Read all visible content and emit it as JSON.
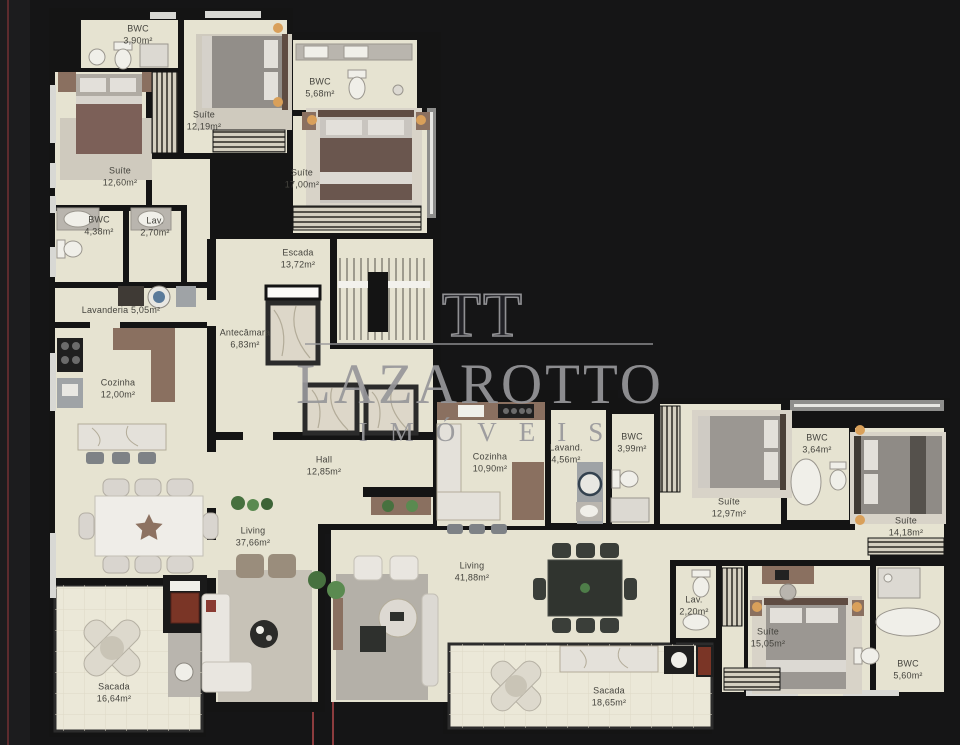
{
  "watermark": {
    "logo": "TT",
    "brand": "LAZAROTTO",
    "subtitle": "IMÓVEIS"
  },
  "colors": {
    "background": "#151516",
    "floor": "#e6e3d1",
    "balcony_floor": "#ebe8d8",
    "wall": "#141414",
    "watermark_gray": "#98989b",
    "guide_red": "#8c3c3e",
    "label_text": "#45443e"
  },
  "rooms": [
    {
      "id": "bwc-390",
      "lines": [
        "BWC",
        "3,90m²"
      ],
      "x": 138,
      "y": 35
    },
    {
      "id": "suite-1219",
      "lines": [
        "Suíte",
        "12,19m²"
      ],
      "x": 204,
      "y": 121
    },
    {
      "id": "bwc-568",
      "lines": [
        "BWC",
        "5,68m²"
      ],
      "x": 320,
      "y": 88
    },
    {
      "id": "suite-1260",
      "lines": [
        "Suíte",
        "12,60m²"
      ],
      "x": 120,
      "y": 177
    },
    {
      "id": "suite-1700",
      "lines": [
        "Suíte",
        "17,00m²"
      ],
      "x": 302,
      "y": 179
    },
    {
      "id": "bwc-438",
      "lines": [
        "BWC",
        "4,38m²"
      ],
      "x": 99,
      "y": 226
    },
    {
      "id": "lav-270",
      "lines": [
        "Lav.",
        "2,70m²"
      ],
      "x": 155,
      "y": 227
    },
    {
      "id": "escada",
      "lines": [
        "Escada",
        "13,72m²"
      ],
      "x": 298,
      "y": 259
    },
    {
      "id": "lavanderia",
      "lines": [
        "Lavanderia 5,05m²"
      ],
      "x": 121,
      "y": 311
    },
    {
      "id": "antecamara",
      "lines": [
        "Antecâmara",
        "6,83m²"
      ],
      "x": 245,
      "y": 339
    },
    {
      "id": "cozinha-1200",
      "lines": [
        "Cozinha",
        "12,00m²"
      ],
      "x": 118,
      "y": 389
    },
    {
      "id": "hall",
      "lines": [
        "Hall",
        "12,85m²"
      ],
      "x": 324,
      "y": 466
    },
    {
      "id": "living-3766",
      "lines": [
        "Living",
        "37,66m²"
      ],
      "x": 253,
      "y": 537
    },
    {
      "id": "sacada-1664",
      "lines": [
        "Sacada",
        "16,64m²"
      ],
      "x": 114,
      "y": 693
    },
    {
      "id": "cozinha-1090",
      "lines": [
        "Cozinha",
        "10,90m²"
      ],
      "x": 490,
      "y": 463
    },
    {
      "id": "lavand-456",
      "lines": [
        "Lavand.",
        "4,56m²"
      ],
      "x": 566,
      "y": 454
    },
    {
      "id": "bwc-399",
      "lines": [
        "BWC",
        "3,99m²"
      ],
      "x": 632,
      "y": 443
    },
    {
      "id": "suite-1297",
      "lines": [
        "Suíte",
        "12,97m²"
      ],
      "x": 729,
      "y": 508
    },
    {
      "id": "bwc-364",
      "lines": [
        "BWC",
        "3,64m²"
      ],
      "x": 817,
      "y": 444
    },
    {
      "id": "suite-1418",
      "lines": [
        "Suíte",
        "14,18m²"
      ],
      "x": 906,
      "y": 527
    },
    {
      "id": "living-4188",
      "lines": [
        "Living",
        "41,88m²"
      ],
      "x": 472,
      "y": 572
    },
    {
      "id": "lav-220",
      "lines": [
        "Lav.",
        "2,20m²"
      ],
      "x": 694,
      "y": 606
    },
    {
      "id": "suite-1505",
      "lines": [
        "Suíte",
        "15,05m²"
      ],
      "x": 768,
      "y": 638
    },
    {
      "id": "bwc-560",
      "lines": [
        "BWC",
        "5,60m²"
      ],
      "x": 908,
      "y": 670
    },
    {
      "id": "sacada-1865",
      "lines": [
        "Sacada",
        "18,65m²"
      ],
      "x": 609,
      "y": 697
    }
  ]
}
